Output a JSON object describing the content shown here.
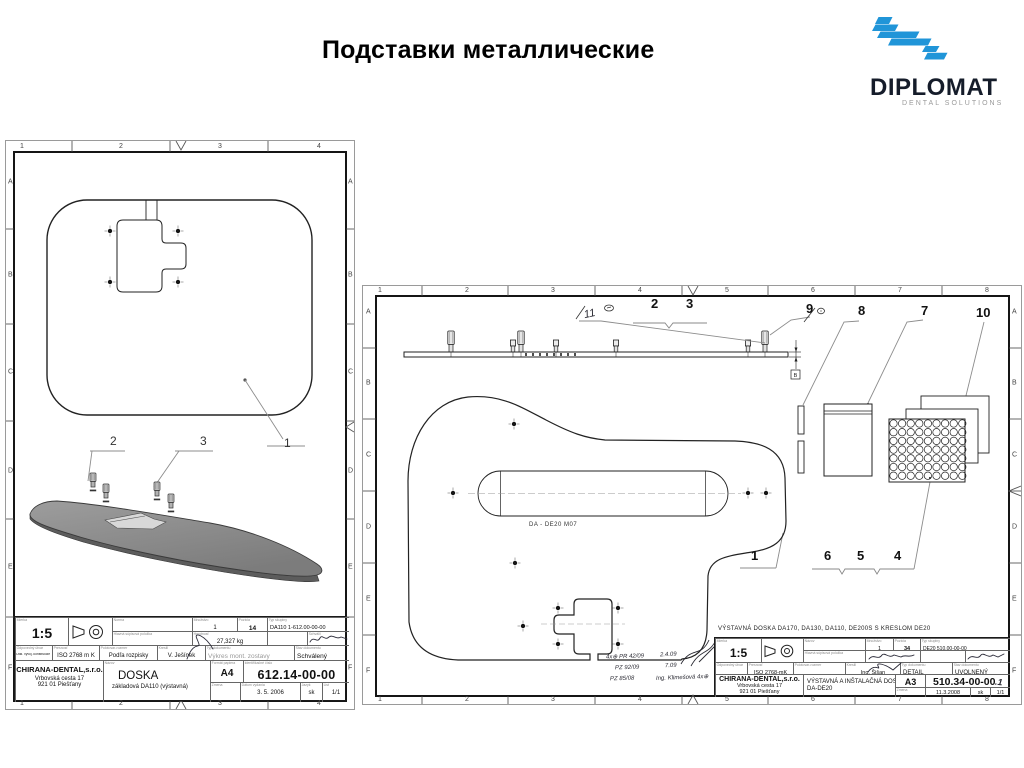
{
  "page": {
    "title": "Подставки металлические"
  },
  "logo": {
    "brand": "DIPLOMAT",
    "tagline": "DENTAL SOLUTIONS",
    "blue": "#2095d8"
  },
  "left": {
    "cols": [
      "1",
      "2",
      "3",
      "4"
    ],
    "rows": [
      "A",
      "B",
      "C",
      "D",
      "E",
      "F"
    ],
    "callouts": {
      "c1": "1",
      "c2": "2",
      "c3": "3"
    },
    "tb": {
      "caps": {
        "scale": "Mierka",
        "proj": "Metóda premietania",
        "norma": "Norma",
        "main": "Hlavná súpisová položka",
        "qty": "Množstvo",
        "pos": "Pozícia",
        "type": "Typ skupiny",
        "mass": "Hmotnosť",
        "appr": "Schválil",
        "dept": "Odpovedný útvar",
        "tol": "Presnosť",
        "blank": "Polotovar-rozmer",
        "drawn": "Kreslil",
        "doctype": "Typ dokumentu",
        "status": "Stav dokumentu",
        "name": "Názov",
        "fmt": "Formát papiera",
        "id": "Identifikačné číslo",
        "change": "Zmena",
        "date": "Dátum vydania",
        "lang": "Jazyk",
        "sheet": "List"
      },
      "scale": "1:5",
      "qty": "1",
      "pos": "14",
      "type": "DA110   1-612.00-00-00",
      "mass": "27,327 kg",
      "dept": "Odd. vývoj. konštrukcie",
      "tol": "ISO 2768 m K",
      "blank": "Podľa rozpisky",
      "drawn": "V. Ješínek",
      "doctype": "Výkres mont. zostavy",
      "status": "Schválený",
      "company": "CHIRANA-DENTAL,s.r.o.",
      "addr1": "Vrbovská cesta 17",
      "addr2": "921 01 Piešťany",
      "title": "DOSKA",
      "subtitle": "základová DA110 (výstavná)",
      "format": "A4",
      "number": "612.14-00-00",
      "date": "3. 5. 2006",
      "lang": "sk",
      "sheet": "1/1"
    }
  },
  "right": {
    "cols": [
      "1",
      "2",
      "3",
      "4",
      "5",
      "6",
      "7",
      "8"
    ],
    "rows": [
      "A",
      "B",
      "C",
      "D",
      "E",
      "F"
    ],
    "callouts": {
      "c1": "1",
      "c2": "2",
      "c3": "3",
      "c4": "4",
      "c5": "5",
      "c6": "6",
      "c7": "7",
      "c8": "8",
      "c9": "9",
      "c10": "10",
      "c11": "11"
    },
    "slot_label": "DA - DE20  M07",
    "dim_label": "B",
    "notes": {
      "a1": "4x⊕ PR 42/09",
      "a2": "PZ 92/09",
      "a3": "PZ 85/08",
      "b1": "2.4.09",
      "b2": "7.09",
      "b3": "Ing. Klimešová 4x⊕"
    },
    "header": "VÝSTAVNÁ  DOSKA   DA170, DA130, DA110, DE200S  S KRESLOM DE20",
    "tb": {
      "scale": "1:5",
      "qty": "1",
      "pos": "34",
      "type": "DE20  510.00-00-00",
      "tol": "ISO 2768-mK",
      "drawn": "Ing. Šišan",
      "doctype": "DETAIL",
      "status": "UVOLNENÝ",
      "company": "CHIRANA-DENTAL,s.r.o.",
      "addr1": "Vrbovská cesta 17",
      "addr2": "921 01 Piešťany",
      "title": "VÝSTAVNÁ A INŠTALAČNÁ DOSKA",
      "subtitle": "DA-DE20",
      "format": "A3",
      "number": "510.34-00-00",
      "suffix": ".1",
      "date": "11.3.2008",
      "lang": "sk",
      "sheet": "1/1"
    }
  }
}
